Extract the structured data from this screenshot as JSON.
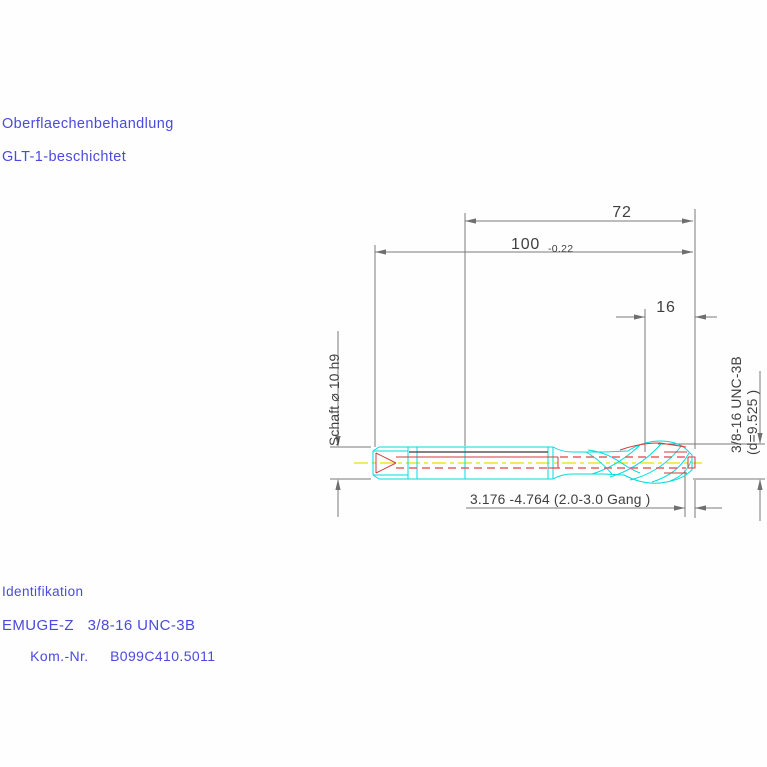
{
  "annotations": {
    "surface_treatment_label": "Oberflaechenbehandlung",
    "coating": "GLT-1-beschichtet",
    "identification_label": "Identifikation",
    "product_name": "EMUGE-Z   3/8-16 UNC-3B",
    "kom_nr_label": "Kom.-Nr.",
    "kom_nr_value": "B099C410.5011"
  },
  "dimensions": {
    "thread_section_length": "72",
    "overall_length": "100",
    "overall_length_tolerance": "-0.22",
    "thread_length": "16",
    "pitch_range": "3.176  -4.764 (2.0-3.0  Gang  )",
    "shank_label": "Schaft  ⌀ 10  h9",
    "thread_designation": "3/8-16  UNC-3B",
    "thread_diameter": "(d=9.525 )"
  },
  "colors": {
    "annotation_blue": "#4a4ade",
    "dimension_gray": "#7b7b7b",
    "dimension_text": "#3f3f3f",
    "tool_outline_cyan": "#00dcdc",
    "tool_internal_red": "#d43a3a",
    "centerline_yellow": "#e3e300",
    "background": "#fefefe"
  }
}
